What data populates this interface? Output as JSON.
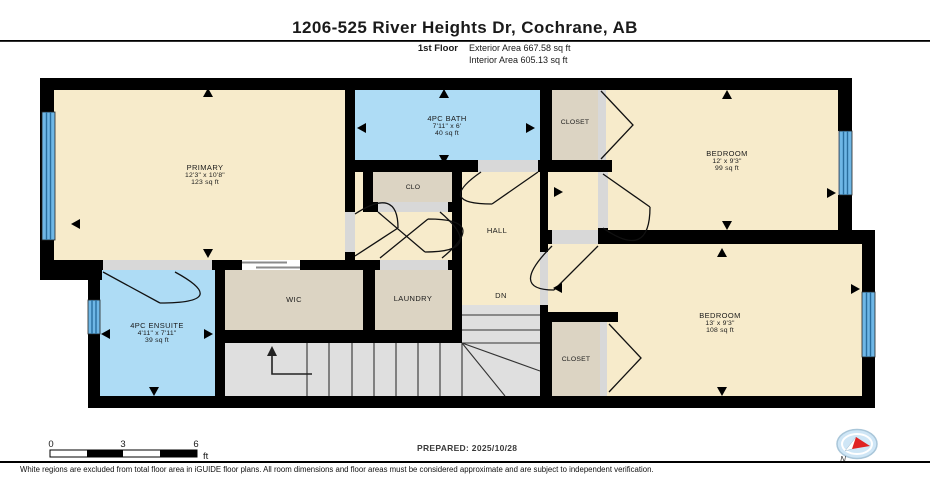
{
  "header": {
    "title": "1206-525 River Heights Dr, Cochrane, AB",
    "floor_label": "1st Floor",
    "exterior_area": "Exterior Area 667.58 sq ft",
    "interior_area": "Interior Area 605.13 sq ft"
  },
  "rooms": {
    "primary": {
      "name": "PRIMARY",
      "dims": "12'3\" x 10'8\"",
      "area": "123 sq ft"
    },
    "bath": {
      "name": "4PC BATH",
      "dims": "7'11\" x 6'",
      "area": "40 sq ft"
    },
    "closet_top": {
      "name": "CLOSET"
    },
    "bedroom_top": {
      "name": "BEDROOM",
      "dims": "12' x 9'3\"",
      "area": "99 sq ft"
    },
    "clo": {
      "name": "CLO"
    },
    "hall": {
      "name": "HALL"
    },
    "wic": {
      "name": "WIC"
    },
    "laundry": {
      "name": "LAUNDRY"
    },
    "ensuite": {
      "name": "4PC ENSUITE",
      "dims": "4'11\" x 7'11\"",
      "area": "39 sq ft"
    },
    "dn": {
      "name": "DN"
    },
    "closet_bottom": {
      "name": "CLOSET"
    },
    "bedroom_bottom": {
      "name": "BEDROOM",
      "dims": "13' x 9'3\"",
      "area": "108 sq ft"
    }
  },
  "footer": {
    "scale": {
      "t0": "0",
      "t3": "3",
      "t6": "6",
      "unit": "ft"
    },
    "prepared": "PREPARED: 2025/10/28",
    "compass_label": "N",
    "disclaimer": "White regions are excluded from total floor area in iGUIDE floor plans. All room dimensions and floor areas must be considered approximate and are subject to independent verification."
  },
  "icons": {
    "compass": "compass-icon",
    "stairs_up": "up-arrow"
  },
  "colors": {
    "room_cream": "#F7EBCB",
    "room_blue": "#AEDCF5",
    "room_tan": "#DCD4C3",
    "stairs_gray": "#DFDFDF",
    "wall_black": "#000000",
    "window_blue": "#6FB7E6",
    "window_line": "#2A6E9E",
    "opening_gray": "#D8D8D8",
    "compass_fill": "#CFE6F6",
    "compass_needle_red": "#E02222"
  }
}
